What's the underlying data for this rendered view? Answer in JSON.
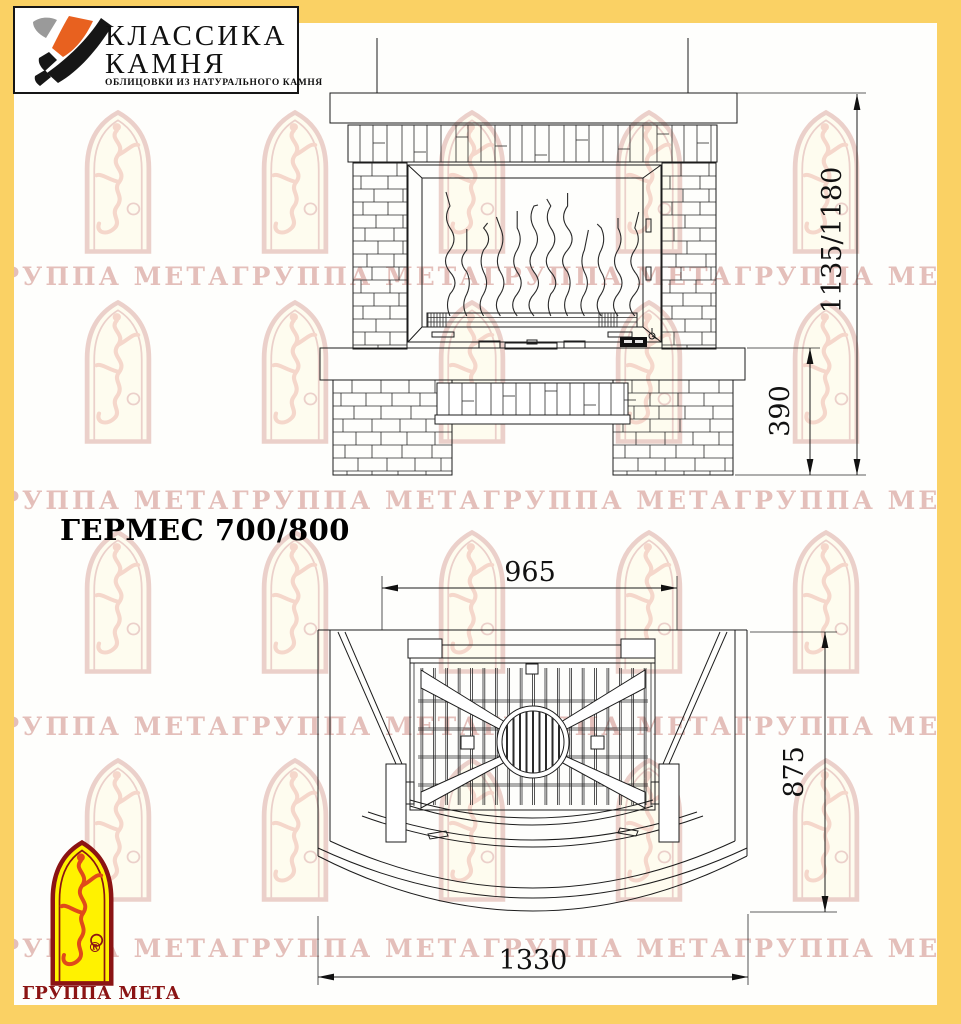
{
  "brand_box": {
    "line1": "КЛАССИКА",
    "line2": "КАМНЯ",
    "subtitle": "ОБЛИЦОВКИ ИЗ НАТУРАЛЬНОГО КАМНЯ"
  },
  "model_title": "ГЕРМЕС 700/800",
  "dimensions": {
    "front_height": "1135/1180",
    "front_base_height": "390",
    "plan_opening_width": "965",
    "plan_depth": "875",
    "plan_width": "1330"
  },
  "footer_brand": {
    "name": "ГРУППА МЕТА",
    "registered": "®"
  },
  "watermark": {
    "tile_text": "ГРУППА МЕТАГРУППА МЕТАГРУППА МЕТАГРУППА МЕТАГРУППА МЕТАГРУППА МЕТА"
  },
  "colors": {
    "frame_yellow": "#FAD164",
    "paper": "#FEFEFC",
    "ink": "#1C1C1C",
    "brand_red": "#8B1414",
    "watermark_red": "#C98078",
    "logo_orange": "#E8611F",
    "logo_yellow": "#FFF200"
  }
}
